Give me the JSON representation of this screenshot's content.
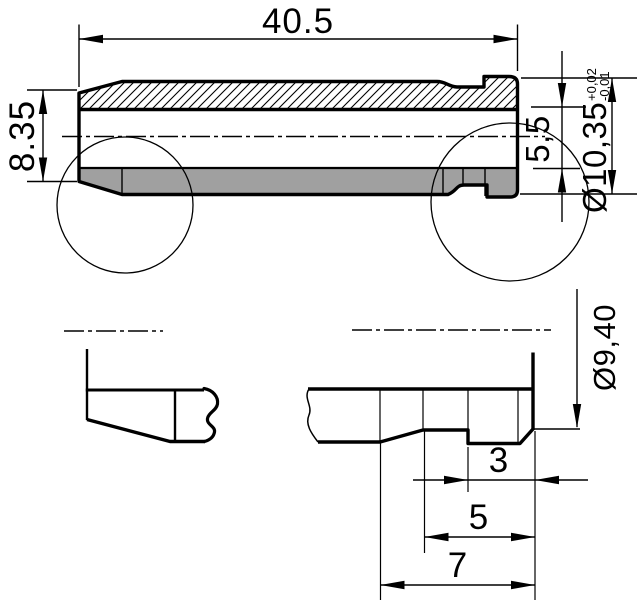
{
  "colors": {
    "line": "#000000",
    "part_fill": "#a0a0a0",
    "background": "#ffffff"
  },
  "main_view": {
    "dim_length": "40.5",
    "dim_height_left": "8.35",
    "dim_bore_height": "5,5",
    "dim_outer_diameter": "Ø10,35",
    "dim_outer_diameter_tol_upper": "+0,02",
    "dim_outer_diameter_tol_lower": "-0,01"
  },
  "bottom_view": {
    "dim_diameter": "Ø9,40",
    "dim_step_width": "3",
    "dim_groove_width": "5",
    "dim_collar_width": "7"
  }
}
